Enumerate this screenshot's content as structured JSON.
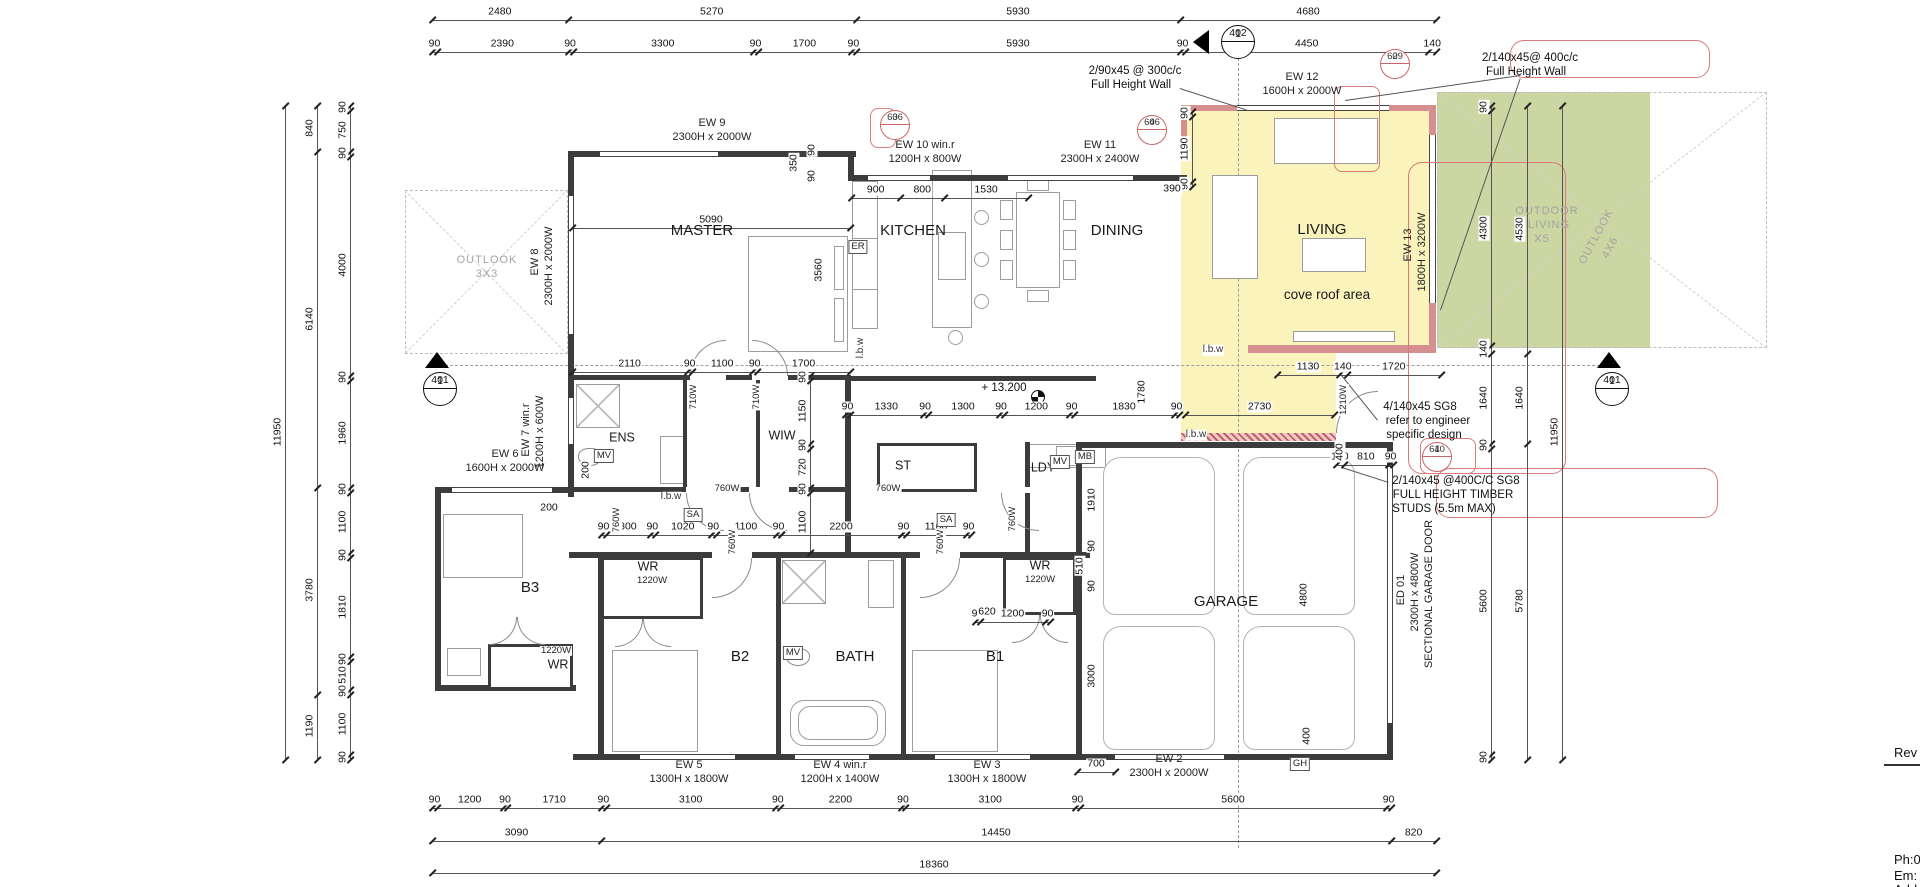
{
  "title_block": {
    "rev_label": "Rev",
    "phone": "Ph:0",
    "email": "Em:",
    "address": "Add"
  },
  "colors": {
    "highlight_yellow": "#faf3bc",
    "outdoor_green": "#ccd6a2",
    "wall_pink": "#d68f8f",
    "annotation_red": "#cc6666",
    "wall_dark": "#3c3c3c"
  },
  "markers": {
    "section_402": {
      "num": "1",
      "sheet": "402"
    },
    "section_401_left": {
      "num": "1",
      "sheet": "401"
    },
    "section_401_right": {
      "num": "1",
      "sheet": "401"
    },
    "detail_3_606": {
      "num": "3",
      "sheet": "606"
    },
    "detail_4_606": {
      "num": "4",
      "sheet": "606"
    },
    "detail_2_609": {
      "num": "2",
      "sheet": "609"
    },
    "detail_4_610": {
      "num": "4",
      "sheet": "610"
    }
  },
  "dims": [
    {
      "n": "dim-top-1",
      "o": "h",
      "x": 432,
      "y": 20,
      "l": 1004,
      "v": [
        2480,
        5270,
        5930,
        4680
      ]
    },
    {
      "n": "dim-top-2",
      "o": "h",
      "x": 432,
      "y": 52,
      "l": 1004,
      "v": [
        90,
        2390,
        90,
        3300,
        90,
        1700,
        90,
        5930,
        90,
        4450,
        140
      ]
    },
    {
      "n": "dim-bottom-1",
      "o": "h",
      "x": 432,
      "y": 808,
      "l": 959,
      "v": [
        90,
        1200,
        90,
        1710,
        90,
        3100,
        90,
        2200,
        90,
        3100,
        90,
        5600,
        90
      ]
    },
    {
      "n": "dim-bottom-2",
      "o": "h",
      "x": 432,
      "y": 841,
      "l": 1004,
      "v": [
        3090,
        14450,
        820
      ]
    },
    {
      "n": "dim-bottom-3",
      "o": "h",
      "x": 432,
      "y": 873,
      "l": 1004,
      "v": [
        18360
      ]
    },
    {
      "n": "dim-left-outer",
      "o": "v",
      "x": 285,
      "y": 105,
      "l": 654,
      "v": [
        11950
      ]
    },
    {
      "n": "dim-left-mid",
      "o": "v",
      "x": 317,
      "y": 105,
      "l": 654,
      "v": [
        840,
        6140,
        3780,
        1190
      ]
    },
    {
      "n": "dim-left-inner",
      "o": "v",
      "x": 350,
      "y": 105,
      "l": 654,
      "v": [
        90,
        750,
        90,
        4000,
        90,
        1960,
        90,
        1100,
        90,
        1810,
        90,
        510,
        90,
        1100,
        90
      ]
    },
    {
      "n": "dim-right-inner",
      "o": "v",
      "x": 1491,
      "y": 105,
      "l": 654,
      "v": [
        90,
        4300,
        140,
        1640,
        90,
        5600,
        90
      ]
    },
    {
      "n": "dim-right-mid",
      "o": "v",
      "x": 1527,
      "y": 105,
      "l": 654,
      "v": [
        4530,
        1640,
        5780
      ]
    },
    {
      "n": "dim-right-outer",
      "o": "v",
      "x": 1562,
      "y": 105,
      "l": 654,
      "v": [
        11950
      ]
    },
    {
      "n": "dim-master-width",
      "o": "h",
      "x": 572,
      "y": 228,
      "l": 278,
      "v": [
        5090
      ]
    },
    {
      "n": "dim-kitchen",
      "o": "h",
      "x": 851,
      "y": 198,
      "l": 177,
      "v": [
        900,
        800,
        1530
      ]
    },
    {
      "n": "dim-master-south",
      "o": "h",
      "x": 572,
      "y": 372,
      "l": 278,
      "v": [
        2110,
        90,
        1100,
        90,
        1700
      ]
    },
    {
      "n": "dim-hall",
      "o": "h",
      "x": 845,
      "y": 415,
      "l": 334,
      "v": [
        90,
        1330,
        90,
        1300,
        90,
        1200,
        90,
        1830,
        90
      ]
    },
    {
      "n": "dim-lounge",
      "o": "h",
      "x": 1185,
      "y": 415,
      "l": 149,
      "v": [
        2730
      ]
    },
    {
      "n": "dim-upper",
      "o": "h",
      "x": 1277,
      "y": 375,
      "l": 164,
      "v": [
        1130,
        140,
        1720
      ]
    },
    {
      "n": "dim-bed-a",
      "o": "h",
      "x": 601,
      "y": 535,
      "l": 180,
      "v": [
        90,
        800,
        90,
        1020,
        90,
        1100,
        90
      ]
    },
    {
      "n": "dim-bed-b",
      "o": "h",
      "x": 781,
      "y": 535,
      "l": 120,
      "v": [
        2200
      ]
    },
    {
      "n": "dim-bed-c",
      "o": "h",
      "x": 901,
      "y": 535,
      "l": 70,
      "v": [
        90,
        1100,
        90
      ]
    },
    {
      "n": "dim-b1",
      "o": "h",
      "x": 975,
      "y": 622,
      "l": 75,
      "v": [
        90,
        1200,
        90
      ]
    },
    {
      "n": "dim-living-left",
      "o": "v",
      "x": 1192,
      "y": 111,
      "l": 75,
      "v": [
        90,
        1190,
        90
      ]
    },
    {
      "n": "dim-wiw",
      "o": "v",
      "x": 810,
      "y": 375,
      "l": 177,
      "v": [
        90,
        1150,
        90,
        720,
        90,
        1100
      ]
    },
    {
      "n": "dim-garage-top",
      "o": "h",
      "x": 1336,
      "y": 465,
      "l": 57,
      "v": [
        140,
        810,
        90
      ]
    },
    {
      "n": "dim-700",
      "o": "h",
      "x": 1077,
      "y": 772,
      "l": 38,
      "v": [
        700
      ]
    }
  ],
  "texts": [
    {
      "n": "room-master",
      "t": "MASTER",
      "x": 702,
      "y": 231,
      "k": "room"
    },
    {
      "n": "room-kitchen",
      "t": "KITCHEN",
      "x": 913,
      "y": 231,
      "k": "room"
    },
    {
      "n": "room-dining",
      "t": "DINING",
      "x": 1117,
      "y": 231,
      "k": "room"
    },
    {
      "n": "room-living",
      "t": "LIVING",
      "x": 1322,
      "y": 230,
      "k": "room"
    },
    {
      "n": "room-garage",
      "t": "GARAGE",
      "x": 1226,
      "y": 602,
      "k": "room"
    },
    {
      "n": "room-b3",
      "t": "B3",
      "x": 530,
      "y": 588,
      "k": "room"
    },
    {
      "n": "room-b2",
      "t": "B2",
      "x": 740,
      "y": 657,
      "k": "room"
    },
    {
      "n": "room-b1",
      "t": "B1",
      "x": 995,
      "y": 657,
      "k": "room"
    },
    {
      "n": "room-bath",
      "t": "BATH",
      "x": 855,
      "y": 657,
      "k": "room"
    },
    {
      "n": "room-ens",
      "t": "ENS",
      "x": 622,
      "y": 438,
      "k": "roomS"
    },
    {
      "n": "room-wiw",
      "t": "WIW",
      "x": 782,
      "y": 436,
      "k": "roomS"
    },
    {
      "n": "room-st",
      "t": "ST",
      "x": 903,
      "y": 466,
      "k": "roomS"
    },
    {
      "n": "room-ldy",
      "t": "LDY",
      "x": 1043,
      "y": 468,
      "k": "roomS"
    },
    {
      "n": "room-wr-1",
      "t": "WR",
      "x": 648,
      "y": 567,
      "k": "roomS"
    },
    {
      "n": "room-wr-2",
      "t": "WR",
      "x": 558,
      "y": 665,
      "k": "roomS"
    },
    {
      "n": "room-wr-3",
      "t": "WR",
      "x": 1040,
      "y": 566,
      "k": "roomS"
    },
    {
      "n": "cove-roof-label",
      "t": "cove roof area",
      "x": 1327,
      "y": 295,
      "k": "room2"
    },
    {
      "n": "outlook-left-label",
      "t": "OUTLOOK",
      "x": 487,
      "y": 261,
      "k": "grey"
    },
    {
      "n": "outlook-left-size",
      "t": "3X3",
      "x": 487,
      "y": 275,
      "k": "grey"
    },
    {
      "n": "outdoor-living-label-1",
      "t": "OUTDOOR",
      "x": 1547,
      "y": 212,
      "k": "grey"
    },
    {
      "n": "outdoor-living-label-2",
      "t": "LIVING",
      "x": 1549,
      "y": 226,
      "k": "grey"
    },
    {
      "n": "outdoor-living-size",
      "t": "X5",
      "x": 1542,
      "y": 240,
      "k": "grey"
    },
    {
      "n": "outlook-right-label",
      "t": "OUTLOOK",
      "x": 1597,
      "y": 237,
      "k": "grey",
      "r": -62
    },
    {
      "n": "outlook-right-size",
      "t": "4X6",
      "x": 1611,
      "y": 248,
      "k": "grey",
      "r": -62
    },
    {
      "n": "window-ew9",
      "t": "EW 9",
      "x": 712,
      "y": 124,
      "k": "win"
    },
    {
      "n": "window-ew9-size",
      "t": "2300H x 2000W",
      "x": 712,
      "y": 138,
      "k": "win"
    },
    {
      "n": "window-ew10",
      "t": "EW 10 win.r",
      "x": 925,
      "y": 146,
      "k": "win"
    },
    {
      "n": "window-ew10-size",
      "t": "1200H x 800W",
      "x": 925,
      "y": 160,
      "k": "win"
    },
    {
      "n": "window-ew11",
      "t": "EW 11",
      "x": 1100,
      "y": 146,
      "k": "win"
    },
    {
      "n": "window-ew11-size",
      "t": "2300H x 2400W",
      "x": 1100,
      "y": 160,
      "k": "win"
    },
    {
      "n": "window-ew12",
      "t": "EW 12",
      "x": 1302,
      "y": 78,
      "k": "win"
    },
    {
      "n": "window-ew12-size",
      "t": "1600H x 2000W",
      "x": 1302,
      "y": 92,
      "k": "win"
    },
    {
      "n": "window-ew13",
      "t": "EW 13",
      "x": 1409,
      "y": 245,
      "k": "win",
      "r": -90
    },
    {
      "n": "window-ew13-size",
      "t": "1800H x 3200W",
      "x": 1423,
      "y": 252,
      "k": "win",
      "r": -90
    },
    {
      "n": "window-ew8",
      "t": "EW 8",
      "x": 536,
      "y": 262,
      "k": "win",
      "r": -90
    },
    {
      "n": "window-ew8-size",
      "t": "2300H x 2000W",
      "x": 550,
      "y": 266,
      "k": "win",
      "r": -90
    },
    {
      "n": "window-ew7",
      "t": "EW 7 win.r",
      "x": 527,
      "y": 430,
      "k": "win",
      "r": -90
    },
    {
      "n": "window-ew7-size",
      "t": "1200H x 600W",
      "x": 541,
      "y": 432,
      "k": "win",
      "r": -90
    },
    {
      "n": "window-ew6",
      "t": "EW 6",
      "x": 505,
      "y": 455,
      "k": "win"
    },
    {
      "n": "window-ew6-size",
      "t": "1600H x 2000W",
      "x": 505,
      "y": 469,
      "k": "win"
    },
    {
      "n": "window-ew5",
      "t": "EW 5",
      "x": 689,
      "y": 766,
      "k": "win"
    },
    {
      "n": "window-ew5-size",
      "t": "1300H x 1800W",
      "x": 689,
      "y": 780,
      "k": "win"
    },
    {
      "n": "window-ew4",
      "t": "EW 4 win.r",
      "x": 840,
      "y": 766,
      "k": "win"
    },
    {
      "n": "window-ew4-size",
      "t": "1200H x 1400W",
      "x": 840,
      "y": 780,
      "k": "win"
    },
    {
      "n": "window-ew3",
      "t": "EW 3",
      "x": 987,
      "y": 766,
      "k": "win"
    },
    {
      "n": "window-ew3-size",
      "t": "1300H x 1800W",
      "x": 987,
      "y": 780,
      "k": "win"
    },
    {
      "n": "window-ew2",
      "t": "EW 2",
      "x": 1169,
      "y": 760,
      "k": "win"
    },
    {
      "n": "window-ew2-size",
      "t": "2300H x 2000W",
      "x": 1169,
      "y": 774,
      "k": "win"
    },
    {
      "n": "door-ed01",
      "t": "ED 01",
      "x": 1402,
      "y": 590,
      "k": "win",
      "r": -90
    },
    {
      "n": "door-ed01-size",
      "t": "2300H x 4800W",
      "x": 1416,
      "y": 592,
      "k": "win",
      "r": -90
    },
    {
      "n": "door-ed01-type",
      "t": "SECTIONAL GARAGE DOOR",
      "x": 1430,
      "y": 594,
      "k": "win",
      "r": -90
    },
    {
      "n": "note-stud-wall-1a",
      "t": "2/90x45 @ 300c/c",
      "x": 1135,
      "y": 71,
      "k": "ann"
    },
    {
      "n": "note-stud-wall-1b",
      "t": "Full Height Wall",
      "x": 1131,
      "y": 85,
      "k": "ann"
    },
    {
      "n": "note-stud-wall-2a",
      "t": "2/140x45@ 400c/c",
      "x": 1530,
      "y": 58,
      "k": "ann"
    },
    {
      "n": "note-stud-wall-2b",
      "t": "Full Height Wall",
      "x": 1526,
      "y": 72,
      "k": "ann"
    },
    {
      "n": "note-engineer-a",
      "t": "4/140x45 SG8",
      "x": 1420,
      "y": 407,
      "k": "ann"
    },
    {
      "n": "note-engineer-b",
      "t": "refer to engineer",
      "x": 1428,
      "y": 421,
      "k": "ann"
    },
    {
      "n": "note-engineer-c",
      "t": "specific design",
      "x": 1424,
      "y": 435,
      "k": "ann"
    },
    {
      "n": "note-studs-a",
      "t": "2/140x45 @400C/C SG8",
      "x": 1456,
      "y": 481,
      "k": "ann"
    },
    {
      "n": "note-studs-b",
      "t": "FULL HEIGHT TIMBER",
      "x": 1453,
      "y": 495,
      "k": "ann"
    },
    {
      "n": "note-studs-c",
      "t": "STUDS (5.5m MAX)",
      "x": 1444,
      "y": 509,
      "k": "ann"
    },
    {
      "n": "level-label",
      "t": "+ 13.200",
      "x": 1004,
      "y": 388,
      "k": "ann"
    },
    {
      "n": "smoke-alarm-box",
      "t": "SA",
      "x": 693,
      "y": 515,
      "k": "box"
    },
    {
      "n": "smoke-alarm-box",
      "t": "SA",
      "x": 946,
      "y": 520,
      "k": "box"
    },
    {
      "n": "mech-vent-box",
      "t": "MV",
      "x": 604,
      "y": 456,
      "k": "box"
    },
    {
      "n": "mech-vent-box",
      "t": "MV",
      "x": 793,
      "y": 653,
      "k": "box"
    },
    {
      "n": "mech-vent-box",
      "t": "MV",
      "x": 1060,
      "y": 462,
      "k": "box"
    },
    {
      "n": "extract-box",
      "t": "ER",
      "x": 858,
      "y": 247,
      "k": "box"
    },
    {
      "n": "meter-box",
      "t": "MB",
      "x": 1085,
      "y": 457,
      "k": "box"
    },
    {
      "n": "gas-heater-box",
      "t": "GH",
      "x": 1300,
      "y": 764,
      "k": "box"
    },
    {
      "n": "lbw-label",
      "t": "l.b.w",
      "x": 861,
      "y": 348,
      "k": "small",
      "r": -90
    },
    {
      "n": "lbw-label",
      "t": "l.b.w",
      "x": 1213,
      "y": 350,
      "k": "small"
    },
    {
      "n": "lbw-label",
      "t": "l.b.w",
      "x": 1196,
      "y": 435,
      "k": "small"
    },
    {
      "n": "lbw-label",
      "t": "l.b.w",
      "x": 671,
      "y": 497,
      "k": "small"
    },
    {
      "n": "door-width-label",
      "t": "760W",
      "x": 727,
      "y": 489,
      "k": "tiny"
    },
    {
      "n": "door-width-label",
      "t": "760W",
      "x": 888,
      "y": 489,
      "k": "tiny"
    },
    {
      "n": "door-width-label",
      "t": "760W",
      "x": 617,
      "y": 520,
      "k": "tiny",
      "r": -90
    },
    {
      "n": "door-width-label",
      "t": "760W",
      "x": 1013,
      "y": 519,
      "k": "tiny",
      "r": -90
    },
    {
      "n": "door-width-label",
      "t": "760W",
      "x": 733,
      "y": 542,
      "k": "tiny",
      "r": -90
    },
    {
      "n": "door-width-label",
      "t": "760W",
      "x": 941,
      "y": 542,
      "k": "tiny",
      "r": -90
    },
    {
      "n": "door-width-label",
      "t": "710W",
      "x": 694,
      "y": 397,
      "k": "tiny",
      "r": -90
    },
    {
      "n": "door-width-label",
      "t": "710W",
      "x": 757,
      "y": 397,
      "k": "tiny",
      "r": -90
    },
    {
      "n": "door-width-label",
      "t": "1210W",
      "x": 1344,
      "y": 400,
      "k": "tiny",
      "r": -90
    },
    {
      "n": "door-width-label",
      "t": "1220W",
      "x": 652,
      "y": 581,
      "k": "tiny"
    },
    {
      "n": "door-width-label",
      "t": "1220W",
      "x": 556,
      "y": 651,
      "k": "tiny"
    },
    {
      "n": "door-width-label",
      "t": "1220W",
      "x": 1040,
      "y": 580,
      "k": "tiny"
    },
    {
      "n": "dim-label-single",
      "t": "620",
      "x": 987,
      "y": 612,
      "k": "dim"
    },
    {
      "n": "dim-label-single",
      "t": "390",
      "x": 1172,
      "y": 189,
      "k": "dim"
    },
    {
      "n": "dim-label-single",
      "t": "350",
      "x": 794,
      "y": 163,
      "k": "dim",
      "r": -90
    },
    {
      "n": "dim-label-single",
      "t": "90",
      "x": 812,
      "y": 150,
      "k": "dim",
      "r": -90
    },
    {
      "n": "dim-label-single",
      "t": "90",
      "x": 812,
      "y": 176,
      "k": "dim",
      "r": -90
    },
    {
      "n": "dim-label-single",
      "t": "3560",
      "x": 819,
      "y": 270,
      "k": "dim",
      "r": -90
    },
    {
      "n": "dim-label-single",
      "t": "1780",
      "x": 1142,
      "y": 392,
      "k": "dim",
      "r": -90
    },
    {
      "n": "dim-label-single",
      "t": "1910",
      "x": 1092,
      "y": 500,
      "k": "dim",
      "r": -90
    },
    {
      "n": "dim-label-single",
      "t": "90",
      "x": 1092,
      "y": 546,
      "k": "dim",
      "r": -90
    },
    {
      "n": "dim-label-single",
      "t": "510",
      "x": 1080,
      "y": 566,
      "k": "dim",
      "r": -90
    },
    {
      "n": "dim-label-single",
      "t": "90",
      "x": 1092,
      "y": 586,
      "k": "dim",
      "r": -90
    },
    {
      "n": "dim-label-single",
      "t": "3000",
      "x": 1092,
      "y": 676,
      "k": "dim",
      "r": -90
    },
    {
      "n": "dim-label-single",
      "t": "4800",
      "x": 1304,
      "y": 595,
      "k": "dim",
      "r": -90
    },
    {
      "n": "dim-label-single",
      "t": "400",
      "x": 1340,
      "y": 452,
      "k": "dim",
      "r": -90
    },
    {
      "n": "dim-label-single",
      "t": "400",
      "x": 1307,
      "y": 736,
      "k": "dim",
      "r": -90
    },
    {
      "n": "dim-label-single",
      "t": "200",
      "x": 549,
      "y": 508,
      "k": "dim"
    },
    {
      "n": "dim-label-single",
      "t": "200",
      "x": 586,
      "y": 470,
      "k": "dim",
      "r": -90
    }
  ]
}
